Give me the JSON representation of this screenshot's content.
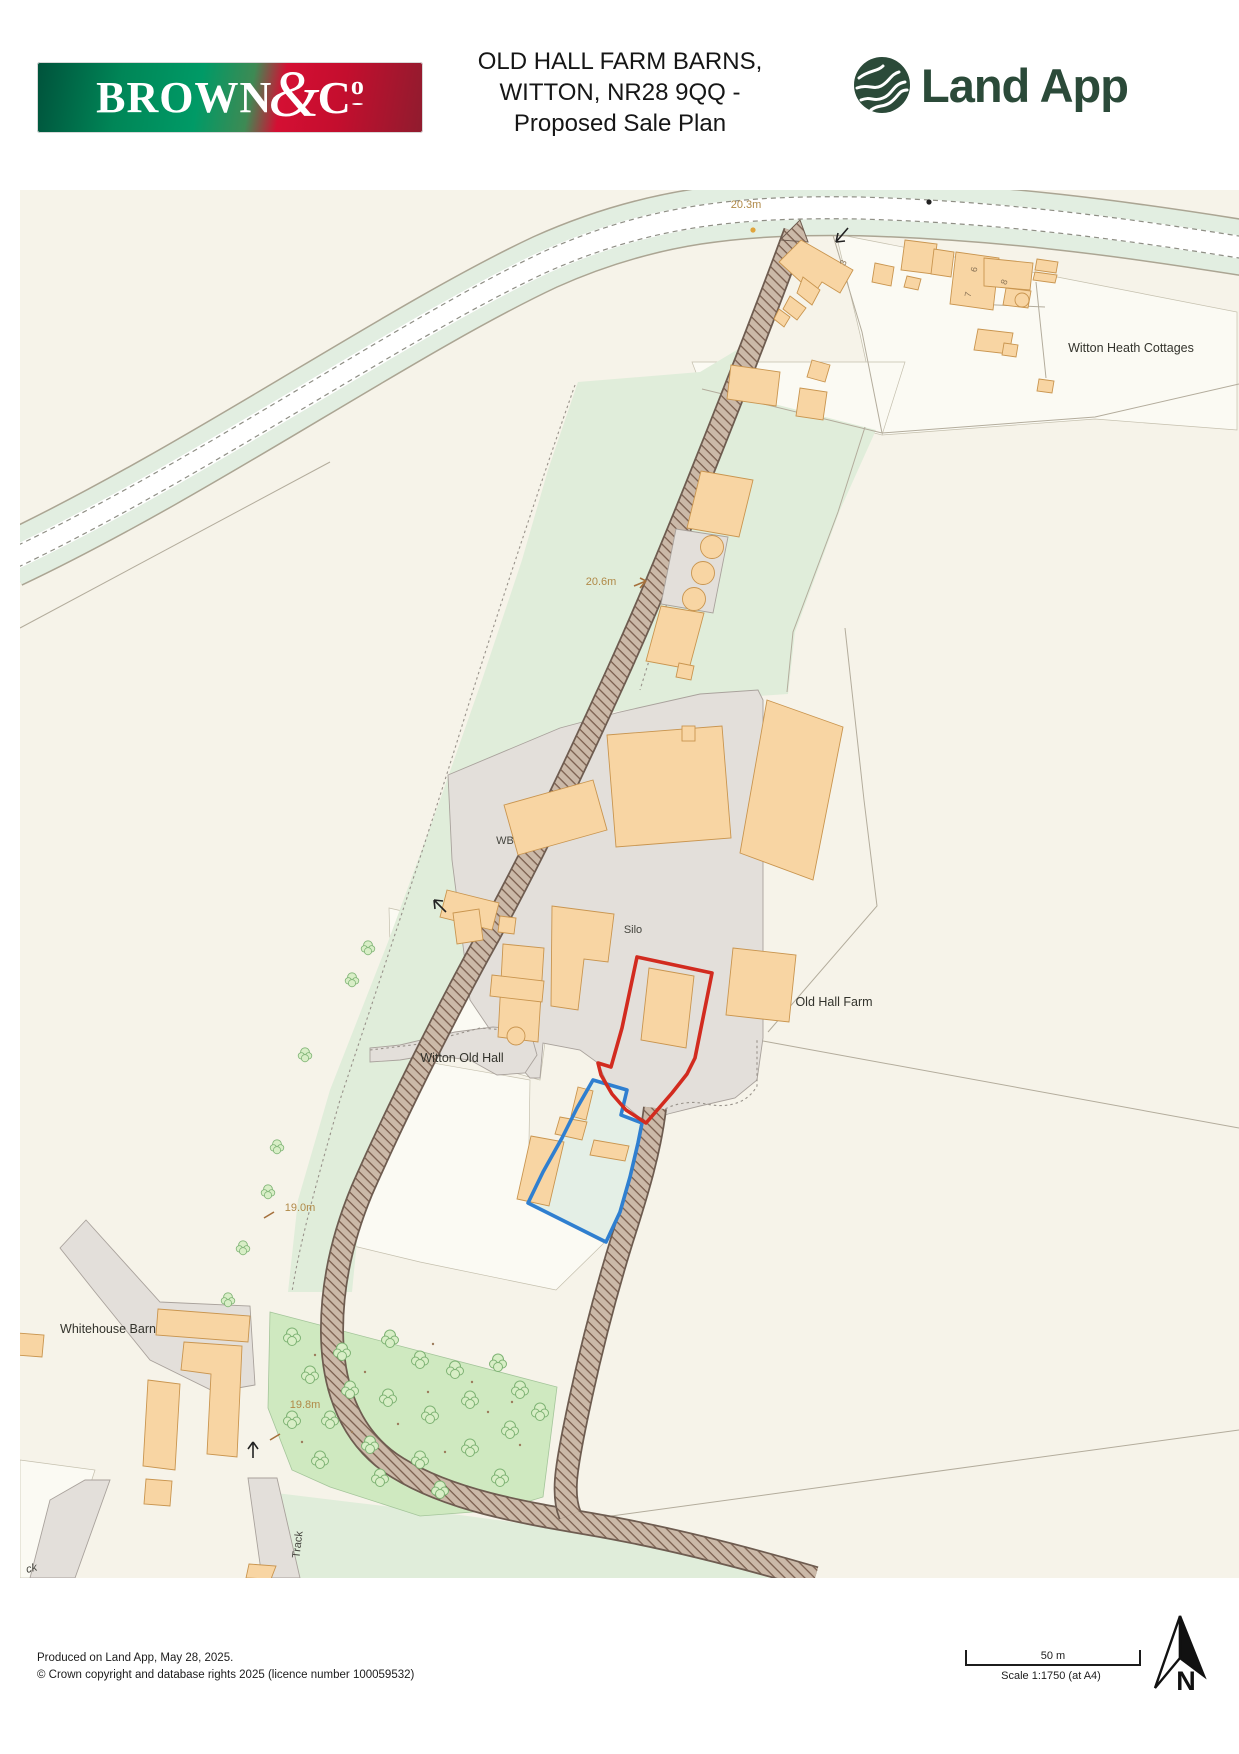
{
  "header": {
    "brown_logo": {
      "brown": "BROWN",
      "amp": "&",
      "c": "C",
      "o": "o"
    },
    "title": {
      "line1": "OLD HALL FARM BARNS,",
      "line2": "WITTON, NR28 9QQ -",
      "line3": "Proposed Sale Plan"
    },
    "landapp_label": "Land App"
  },
  "map": {
    "labels": {
      "spot_20_3": "20.3m",
      "spot_20_6": "20.6m",
      "spot_19_0": "19.0m",
      "spot_19_8": "19.8m",
      "witton_heath_cottages": "Witton Heath Cottages",
      "wb": "WB",
      "silo": "Silo",
      "old_hall_farm": "Old Hall Farm",
      "witton_old_hall": "Witton Old Hall",
      "whitehouse_barn": "Whitehouse Barn",
      "track": "Track",
      "track_partial": "ck",
      "building_3": "3",
      "building_6": "6",
      "building_7": "7",
      "building_8": "8"
    },
    "colors": {
      "background_cream": "#f6f3e9",
      "field_green": "#e0edda",
      "woodland_green": "#cfe9c0",
      "building_orange": "#f8d5a3",
      "yard_grey": "#e3dfda",
      "track_brown": "#7a5e4e",
      "red_boundary": "#d22b1f",
      "blue_boundary": "#2f7fd0",
      "elevation_text": "#b08947"
    }
  },
  "footer": {
    "produced": "Produced on Land App, May 28, 2025.",
    "copyright": "© Crown copyright and database rights 2025 (licence number 100059532)",
    "scale_bar_label": "50 m",
    "scale_text": "Scale 1:1750 (at A4)",
    "north_label": "N"
  }
}
